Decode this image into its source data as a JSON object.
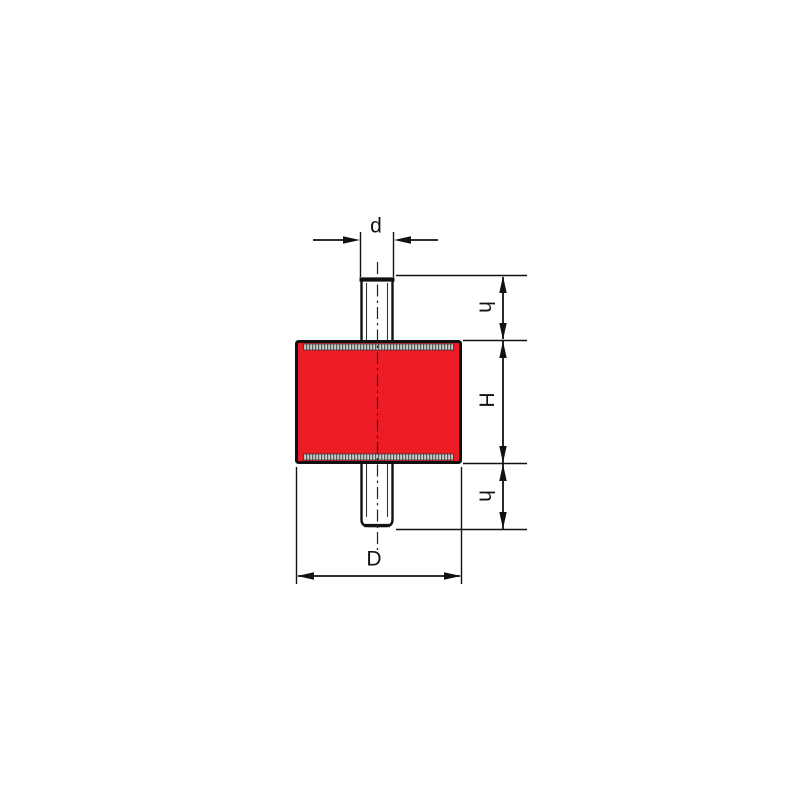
{
  "diagram": {
    "kind": "technical-drawing",
    "part": "cylindrical rubber-metal vibration mount with threaded studs",
    "dimensions": [
      {
        "id": "stud-diameter",
        "label": "d"
      },
      {
        "id": "upper-stud-length",
        "label": "h"
      },
      {
        "id": "body-height",
        "label": "H"
      },
      {
        "id": "lower-stud-length",
        "label": "h"
      },
      {
        "id": "body-diameter",
        "label": "D"
      }
    ],
    "colors": {
      "rubber": "#ED1C24",
      "line": "#111111",
      "plate_hatch_light": "#CDCDCD",
      "plate_hatch_dark": "#5A5A5A",
      "background": "#FFFFFF"
    }
  }
}
